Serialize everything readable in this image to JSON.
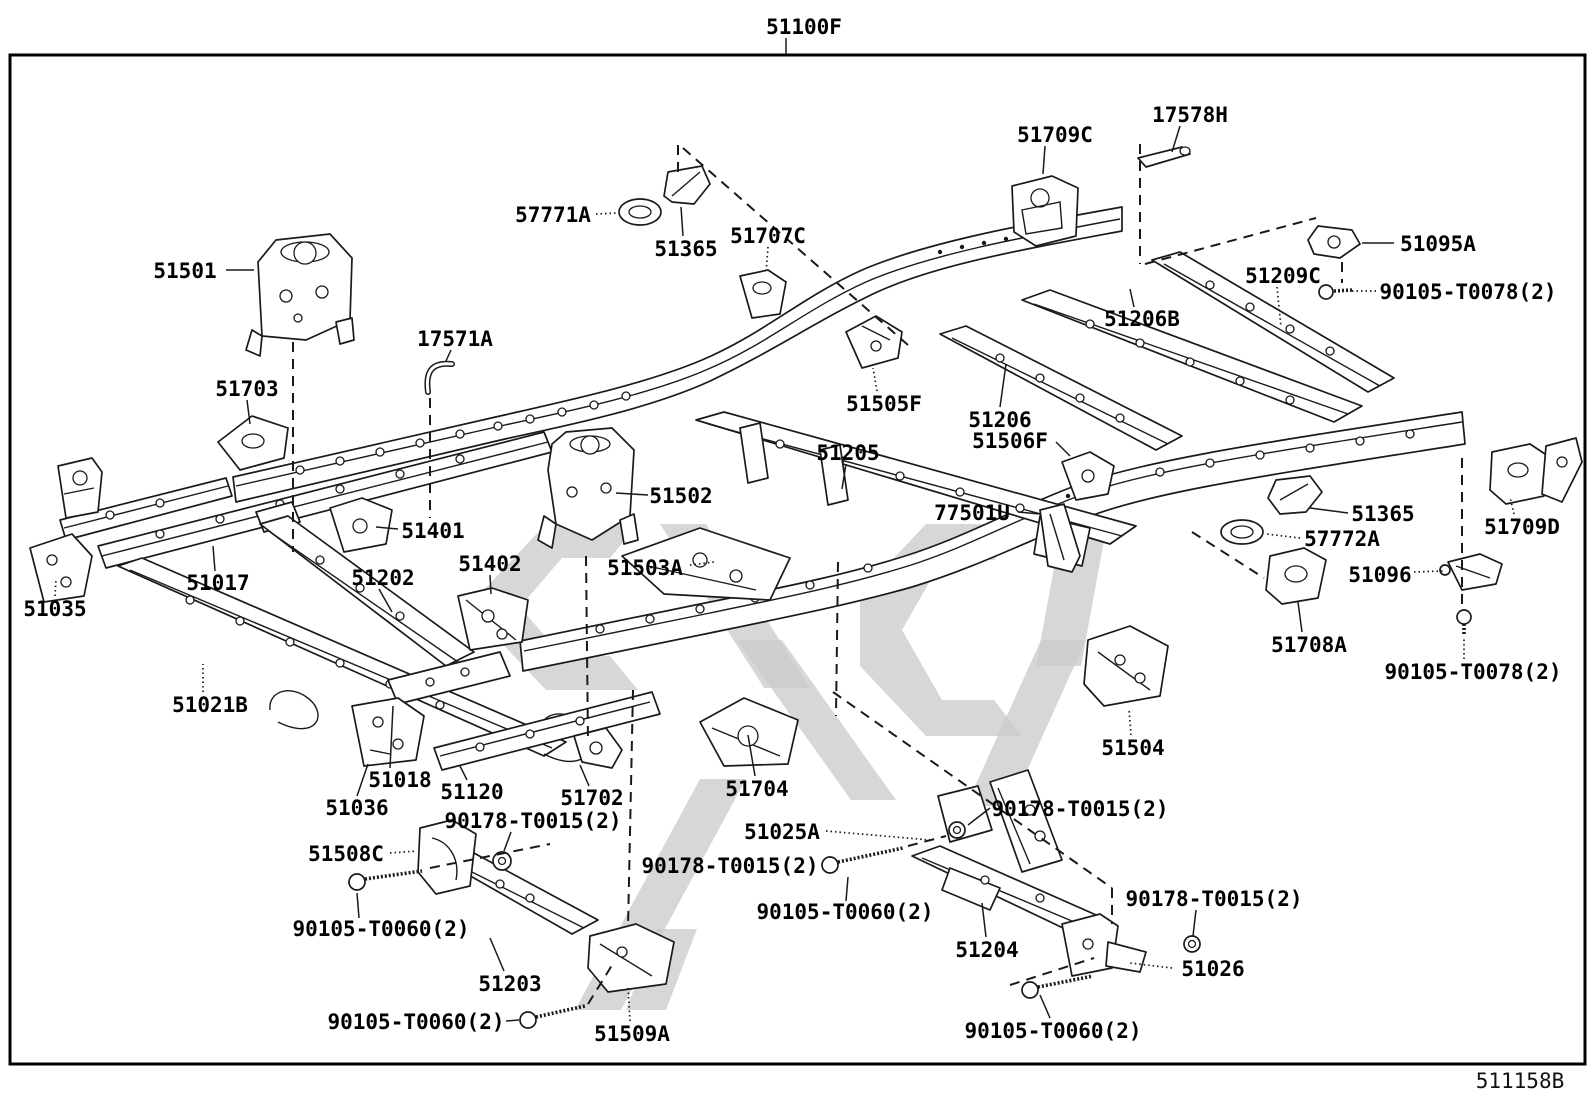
{
  "diagram": {
    "figure_code": "511158B",
    "assembly_label": "51100F",
    "colors": {
      "line": "#1a1a1a",
      "watermark": "#cccccc",
      "background": "#ffffff",
      "label": "#000000"
    },
    "labels": [
      {
        "text": "51100F",
        "x": 804,
        "y": 26,
        "leader": [
          786,
          38,
          786,
          54
        ],
        "style": "solid"
      },
      {
        "text": "17578H",
        "x": 1190,
        "y": 114,
        "leader": [
          1180,
          126,
          1172,
          152
        ],
        "style": "solid"
      },
      {
        "text": "51709C",
        "x": 1055,
        "y": 134,
        "leader": [
          1045,
          146,
          1043,
          174
        ],
        "style": "solid"
      },
      {
        "text": "57771A",
        "x": 553,
        "y": 214,
        "leader": [
          596,
          214,
          618,
          213
        ],
        "style": "dotted"
      },
      {
        "text": "51365",
        "x": 686,
        "y": 248,
        "leader": [
          683,
          236,
          681,
          207
        ],
        "style": "solid"
      },
      {
        "text": "51707C",
        "x": 768,
        "y": 235,
        "leader": [
          768,
          247,
          766,
          273
        ],
        "style": "dotted"
      },
      {
        "text": "51095A",
        "x": 1438,
        "y": 243,
        "leader": [
          1394,
          243,
          1362,
          243
        ],
        "style": "solid"
      },
      {
        "text": "90105-T0078(2)",
        "x": 1468,
        "y": 291,
        "leader": [
          1376,
          291,
          1352,
          291
        ],
        "style": "dotted"
      },
      {
        "text": "51209C",
        "x": 1283,
        "y": 275,
        "leader": [
          1277,
          287,
          1281,
          327
        ],
        "style": "dotted"
      },
      {
        "text": "51206B",
        "x": 1142,
        "y": 318,
        "leader": [
          1134,
          307,
          1130,
          289
        ],
        "style": "solid"
      },
      {
        "text": "51501",
        "x": 185,
        "y": 270,
        "leader": [
          226,
          270,
          254,
          270
        ],
        "style": "solid"
      },
      {
        "text": "17571A",
        "x": 455,
        "y": 338,
        "leader": [
          451,
          350,
          446,
          361
        ],
        "style": "solid"
      },
      {
        "text": "51703",
        "x": 247,
        "y": 388,
        "leader": [
          247,
          400,
          250,
          424
        ],
        "style": "solid"
      },
      {
        "text": "51505F",
        "x": 884,
        "y": 403,
        "leader": [
          877,
          391,
          873,
          368
        ],
        "style": "dotted"
      },
      {
        "text": "51206",
        "x": 1000,
        "y": 419,
        "leader": [
          1000,
          407,
          1006,
          364
        ],
        "style": "solid"
      },
      {
        "text": "51506F",
        "x": 1010,
        "y": 440,
        "leader": [
          1056,
          442,
          1070,
          456
        ],
        "style": "solid"
      },
      {
        "text": "51205",
        "x": 848,
        "y": 452,
        "leader": [
          846,
          464,
          842,
          489
        ],
        "style": "solid"
      },
      {
        "text": "77501U",
        "x": 972,
        "y": 512,
        "leader": [
          1018,
          512,
          1040,
          514
        ],
        "style": "solid"
      },
      {
        "text": "51365",
        "x": 1383,
        "y": 513,
        "leader": [
          1348,
          513,
          1310,
          508
        ],
        "style": "solid"
      },
      {
        "text": "57772A",
        "x": 1342,
        "y": 538,
        "leader": [
          1300,
          538,
          1266,
          534
        ],
        "style": "dotted"
      },
      {
        "text": "51709D",
        "x": 1522,
        "y": 526,
        "leader": [
          1514,
          514,
          1510,
          497
        ],
        "style": "dotted"
      },
      {
        "text": "51502",
        "x": 681,
        "y": 495,
        "leader": [
          648,
          495,
          616,
          493
        ],
        "style": "solid"
      },
      {
        "text": "51401",
        "x": 433,
        "y": 530,
        "leader": [
          398,
          529,
          376,
          527
        ],
        "style": "solid"
      },
      {
        "text": "51402",
        "x": 490,
        "y": 563,
        "leader": [
          490,
          575,
          491,
          594
        ],
        "style": "solid"
      },
      {
        "text": "51503A",
        "x": 645,
        "y": 567,
        "leader": [
          690,
          565,
          714,
          562
        ],
        "style": "dotted"
      },
      {
        "text": "51096",
        "x": 1380,
        "y": 574,
        "leader": [
          1414,
          572,
          1443,
          571
        ],
        "style": "dotted"
      },
      {
        "text": "51017",
        "x": 218,
        "y": 582,
        "leader": [
          215,
          571,
          213,
          546
        ],
        "style": "solid"
      },
      {
        "text": "51202",
        "x": 383,
        "y": 577,
        "leader": [
          379,
          589,
          392,
          612
        ],
        "style": "solid"
      },
      {
        "text": "51035",
        "x": 55,
        "y": 608,
        "leader": [
          55,
          596,
          56,
          579
        ],
        "style": "dotted"
      },
      {
        "text": "51708A",
        "x": 1309,
        "y": 644,
        "leader": [
          1302,
          632,
          1298,
          602
        ],
        "style": "solid"
      },
      {
        "text": "51021B",
        "x": 210,
        "y": 704,
        "leader": [
          203,
          692,
          203,
          664
        ],
        "style": "dotted"
      },
      {
        "text": "90105-T0078(2)",
        "x": 1473,
        "y": 671,
        "leader": [
          1464,
          659,
          1464,
          637
        ],
        "style": "dotted"
      },
      {
        "text": "51504",
        "x": 1133,
        "y": 747,
        "leader": [
          1131,
          735,
          1129,
          709
        ],
        "style": "dotted"
      },
      {
        "text": "51018",
        "x": 400,
        "y": 779,
        "leader": [
          390,
          768,
          393,
          706
        ],
        "style": "solid"
      },
      {
        "text": "51120",
        "x": 472,
        "y": 791,
        "leader": [
          467,
          780,
          460,
          766
        ],
        "style": "solid"
      },
      {
        "text": "51702",
        "x": 592,
        "y": 797,
        "leader": [
          589,
          786,
          580,
          765
        ],
        "style": "solid"
      },
      {
        "text": "51704",
        "x": 757,
        "y": 788,
        "leader": [
          755,
          776,
          748,
          735
        ],
        "style": "solid"
      },
      {
        "text": "51036",
        "x": 357,
        "y": 807,
        "leader": [
          357,
          796,
          368,
          764
        ],
        "style": "solid"
      },
      {
        "text": "90178-T0015(2)",
        "x": 533,
        "y": 820,
        "leader": [
          511,
          832,
          504,
          851
        ],
        "style": "solid"
      },
      {
        "text": "51025A",
        "x": 782,
        "y": 831,
        "leader": [
          826,
          831,
          930,
          840
        ],
        "style": "dotted"
      },
      {
        "text": "90178-T0015(2)",
        "x": 1080,
        "y": 808,
        "leader": [
          990,
          808,
          968,
          825
        ],
        "style": "solid"
      },
      {
        "text": "51508C",
        "x": 346,
        "y": 853,
        "leader": [
          390,
          853,
          417,
          851
        ],
        "style": "dotted"
      },
      {
        "text": "90178-T0015(2)",
        "x": 730,
        "y": 865,
        "leader": null,
        "style": "solid"
      },
      {
        "text": "90105-T0060(2)",
        "x": 381,
        "y": 928,
        "leader": [
          359,
          918,
          357,
          893
        ],
        "style": "solid"
      },
      {
        "text": "51203",
        "x": 510,
        "y": 983,
        "leader": [
          504,
          971,
          490,
          938
        ],
        "style": "solid"
      },
      {
        "text": "90105-T0060(2)",
        "x": 416,
        "y": 1021,
        "leader": [
          506,
          1021,
          519,
          1020
        ],
        "style": "solid"
      },
      {
        "text": "51509A",
        "x": 632,
        "y": 1033,
        "leader": [
          630,
          1021,
          628,
          987
        ],
        "style": "dotted"
      },
      {
        "text": "90105-T0060(2)",
        "x": 845,
        "y": 911,
        "leader": [
          846,
          901,
          848,
          877
        ],
        "style": "solid"
      },
      {
        "text": "51204",
        "x": 987,
        "y": 949,
        "leader": [
          986,
          937,
          982,
          903
        ],
        "style": "solid"
      },
      {
        "text": "90178-T0015(2)",
        "x": 1214,
        "y": 898,
        "leader": [
          1196,
          910,
          1193,
          936
        ],
        "style": "solid"
      },
      {
        "text": "51026",
        "x": 1213,
        "y": 968,
        "leader": [
          1172,
          968,
          1130,
          963
        ],
        "style": "dotted"
      },
      {
        "text": "90105-T0060(2)",
        "x": 1053,
        "y": 1030,
        "leader": [
          1050,
          1018,
          1040,
          995
        ],
        "style": "solid"
      }
    ],
    "dash_lines": [
      [
        678,
        172,
        678,
        144
      ],
      [
        683,
        148,
        908,
        345
      ],
      [
        1140,
        144,
        1140,
        264
      ],
      [
        1145,
        264,
        1316,
        218
      ],
      [
        1342,
        262,
        1342,
        283
      ],
      [
        293,
        342,
        293,
        552
      ],
      [
        430,
        398,
        430,
        518
      ],
      [
        586,
        556,
        588,
        742
      ],
      [
        633,
        690,
        628,
        928
      ],
      [
        838,
        562,
        836,
        716
      ],
      [
        833,
        692,
        1112,
        888
      ],
      [
        1112,
        888,
        1112,
        924
      ],
      [
        1192,
        532,
        1264,
        578
      ],
      [
        1462,
        458,
        1462,
        604
      ],
      [
        430,
        868,
        550,
        844
      ],
      [
        588,
        1004,
        614,
        962
      ],
      [
        908,
        846,
        946,
        836
      ],
      [
        1010,
        985,
        1094,
        958
      ]
    ]
  }
}
